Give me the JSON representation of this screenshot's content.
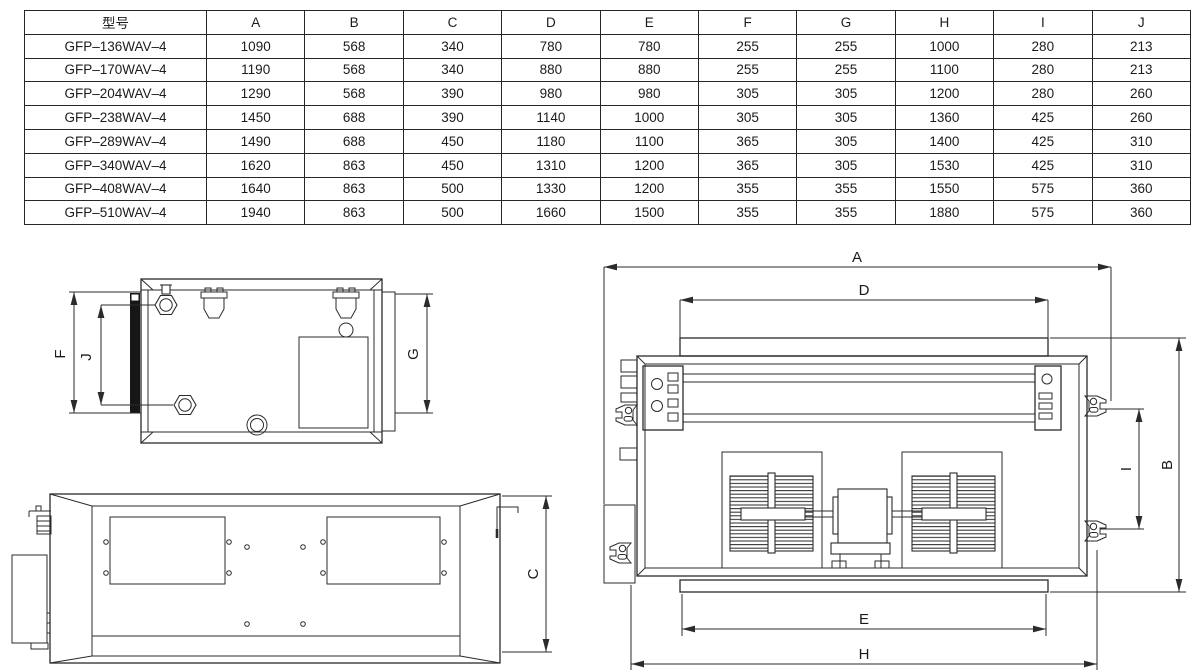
{
  "table": {
    "headers": [
      "型号",
      "A",
      "B",
      "C",
      "D",
      "E",
      "F",
      "G",
      "H",
      "I",
      "J"
    ],
    "rows": [
      [
        "GFP–136WAV–4",
        "1090",
        "568",
        "340",
        "780",
        "780",
        "255",
        "255",
        "1000",
        "280",
        "213"
      ],
      [
        "GFP–170WAV–4",
        "1190",
        "568",
        "340",
        "880",
        "880",
        "255",
        "255",
        "1100",
        "280",
        "213"
      ],
      [
        "GFP–204WAV–4",
        "1290",
        "568",
        "390",
        "980",
        "980",
        "305",
        "305",
        "1200",
        "280",
        "260"
      ],
      [
        "GFP–238WAV–4",
        "1450",
        "688",
        "390",
        "1140",
        "1000",
        "305",
        "305",
        "1360",
        "425",
        "260"
      ],
      [
        "GFP–289WAV–4",
        "1490",
        "688",
        "450",
        "1180",
        "1100",
        "365",
        "305",
        "1400",
        "425",
        "310"
      ],
      [
        "GFP–340WAV–4",
        "1620",
        "863",
        "450",
        "1310",
        "1200",
        "365",
        "305",
        "1530",
        "425",
        "310"
      ],
      [
        "GFP–408WAV–4",
        "1640",
        "863",
        "500",
        "1330",
        "1200",
        "355",
        "355",
        "1550",
        "575",
        "360"
      ],
      [
        "GFP–510WAV–4",
        "1940",
        "863",
        "500",
        "1660",
        "1500",
        "355",
        "355",
        "1880",
        "575",
        "360"
      ]
    ]
  },
  "drawings": {
    "side_view": {
      "labels": {
        "F": "F",
        "J": "J",
        "G": "G"
      }
    },
    "front_view": {
      "labels": {
        "C": "C"
      }
    },
    "top_view": {
      "labels": {
        "A": "A",
        "D": "D",
        "B": "B",
        "I": "I",
        "E": "E",
        "H": "H"
      }
    }
  },
  "colors": {
    "line": "#2b2b2b",
    "background": "#ffffff"
  }
}
